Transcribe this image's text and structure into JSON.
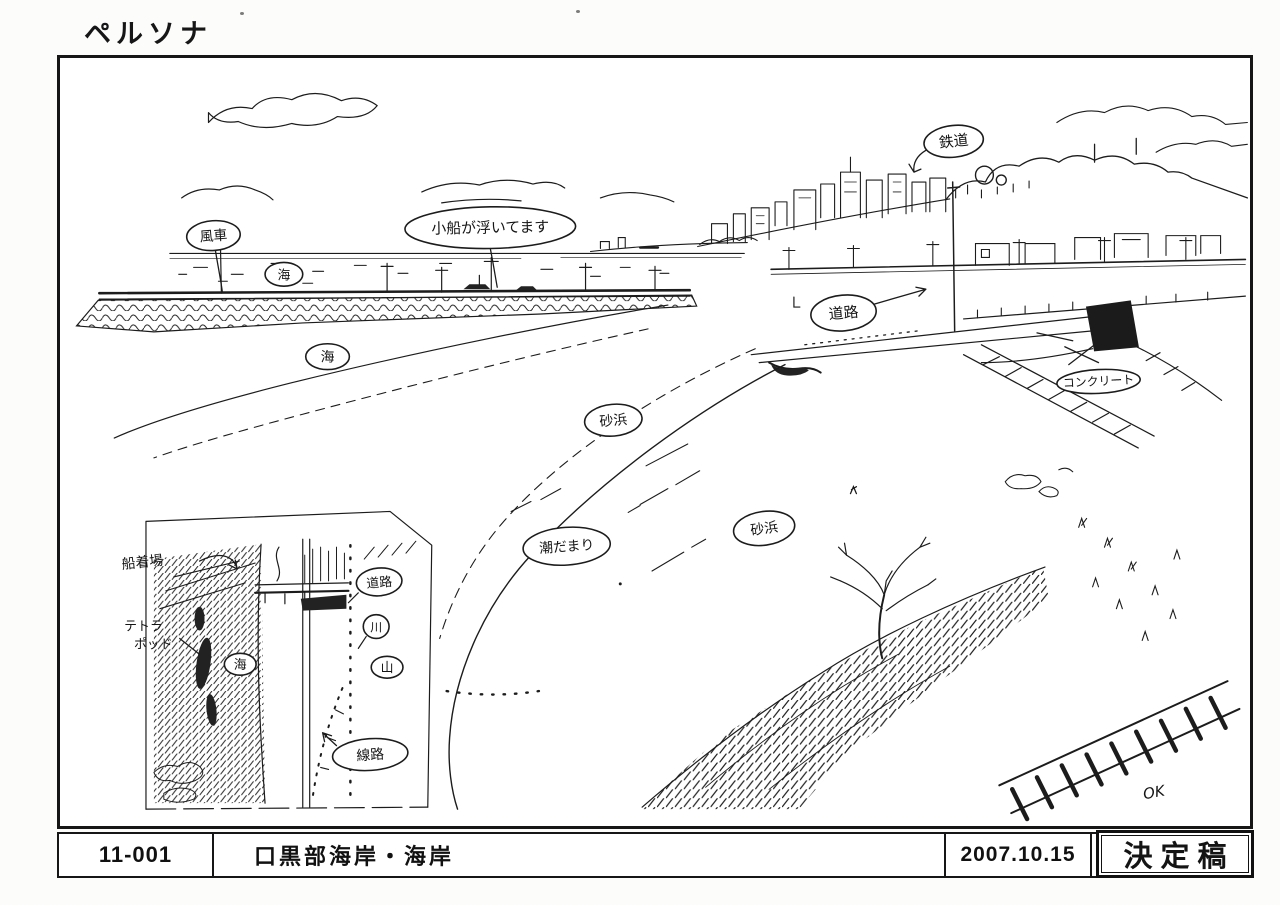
{
  "sheet": {
    "series_title": "ペルソナ",
    "cut_number": "11-001",
    "scene_title": "口黒部海岸・海岸",
    "date": "2007.10.15",
    "approval_stamp": "決定稿"
  },
  "drawing": {
    "labels": {
      "windmill": "風車",
      "sea_small": "海",
      "boats_note": "小船が浮いてます",
      "railway": "鉄道",
      "road": "道路",
      "concrete": "コンクリート",
      "sea": "海",
      "beach_upper": "砂浜",
      "tide_pool": "潮だまり",
      "beach_lower": "砂浜"
    },
    "inset_labels": {
      "dock": "船着場",
      "tetrapod_line1": "テトラ",
      "tetrapod_line2": "ポッド",
      "sea": "海",
      "road": "道路",
      "river": "川",
      "mountain": "山",
      "tracks": "線路"
    },
    "ok_mark": "OK"
  },
  "colors": {
    "ink": "#1c1c1c",
    "paper": "#ffffff"
  }
}
